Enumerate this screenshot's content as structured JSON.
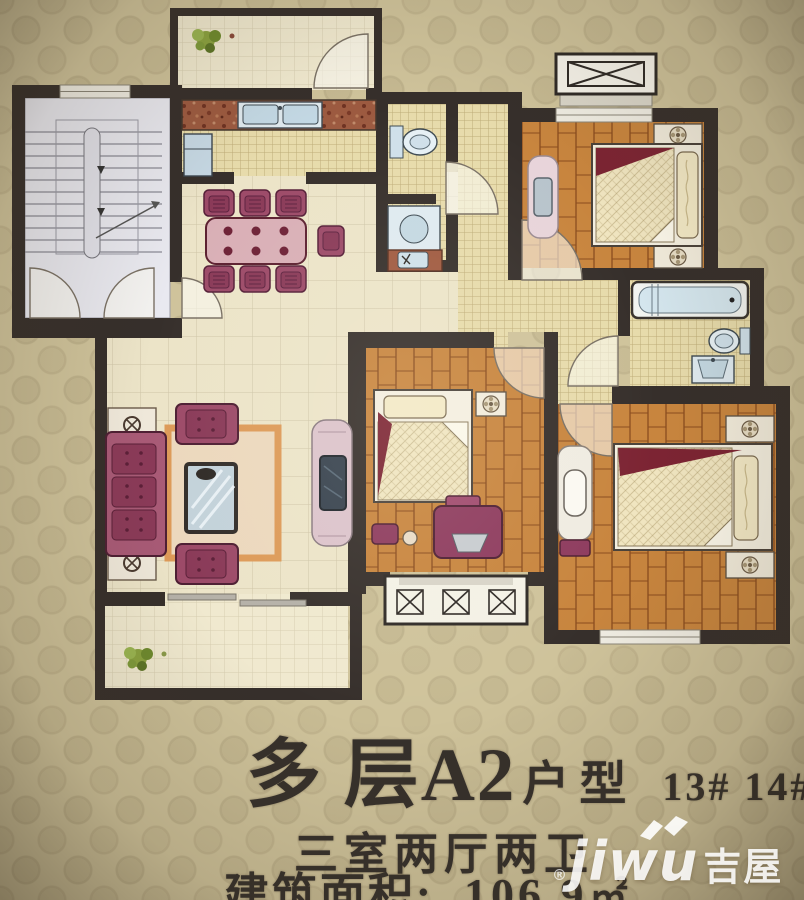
{
  "caption": {
    "title_main": "多 层A2",
    "title_type": "户型",
    "unit_numbers": "13# 14#",
    "rooms_summary": "三室两厅两卫",
    "area_label": "建筑面积:",
    "area_value": "106.9",
    "area_unit": "㎡"
  },
  "watermark": {
    "registered_mark": "®",
    "latin": "jiwu",
    "cn": "吉屋"
  },
  "legend_colors": {
    "wall": "#362f2b",
    "wood_floor": "#c8853e",
    "tile_floor": "#e7dbab",
    "large_tile_floor": "#ece4c8",
    "paper_background": "#cfc39b",
    "accent_red": "#7c2433",
    "furniture_maroon": "#9c4a68",
    "fixture_blue": "#cfe3ee",
    "stairwell_floor": "#e9e9f0"
  }
}
